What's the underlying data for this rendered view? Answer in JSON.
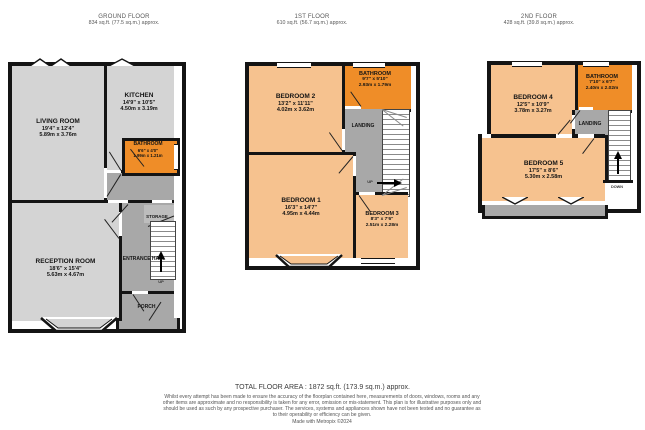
{
  "colors": {
    "wall": "#141414",
    "room_gray": "#d4d4d4",
    "hall_gray": "#a8a8a8",
    "bedroom_peach": "#f6c28f",
    "bathroom_orange": "#ef8d28"
  },
  "floors": [
    {
      "name": "GROUND FLOOR",
      "area": "834 sq.ft. (77.5 sq.m.) approx.",
      "rooms": {
        "living": {
          "name": "LIVING ROOM",
          "imperial": "19'4\" x 12'4\"",
          "metric": "5.89m x 3.76m"
        },
        "kitchen": {
          "name": "KITCHEN",
          "imperial": "14'9\" x 10'5\"",
          "metric": "4.50m x 3.19m"
        },
        "bathroom": {
          "name": "BATHROOM",
          "imperial": "6'6\" x 4'0\"",
          "metric": "1.99m x 1.21m"
        },
        "reception": {
          "name": "RECEPTION ROOM",
          "imperial": "18'6\" x 15'4\"",
          "metric": "5.63m x 4.67m"
        },
        "entrance": {
          "name": "ENTRANCE HALL"
        },
        "storage": {
          "name": "STORAGE"
        },
        "porch": {
          "name": "PORCH"
        }
      },
      "stairs": {
        "label": "UP"
      }
    },
    {
      "name": "1ST FLOOR",
      "area": "610 sq.ft. (56.7 sq.m.) approx.",
      "rooms": {
        "bedroom2": {
          "name": "BEDROOM 2",
          "imperial": "13'2\" x 11'11\"",
          "metric": "4.02m x 3.62m"
        },
        "bathroom": {
          "name": "BATHROOM",
          "imperial": "9'7\" x 5'10\"",
          "metric": "2.93m x 1.79m"
        },
        "landing": {
          "name": "LANDING"
        },
        "bedroom1": {
          "name": "BEDROOM 1",
          "imperial": "16'3\" x 14'7\"",
          "metric": "4.95m x 4.44m"
        },
        "bedroom3": {
          "name": "BEDROOM 3",
          "imperial": "8'3\" x 7'6\"",
          "metric": "2.51m x 2.28m"
        }
      },
      "stairs": {
        "label": "UP"
      }
    },
    {
      "name": "2ND FLOOR",
      "area": "428 sq.ft. (39.8 sq.m.) approx.",
      "rooms": {
        "bedroom4": {
          "name": "BEDROOM 4",
          "imperial": "12'5\" x 10'9\"",
          "metric": "3.78m x 3.27m"
        },
        "bathroom": {
          "name": "BATHROOM",
          "imperial": "7'10\" x 6'7\"",
          "metric": "2.40m x 2.02m"
        },
        "landing": {
          "name": "LANDING"
        },
        "bedroom5": {
          "name": "BEDROOM 5",
          "imperial": "17'5\" x 8'6\"",
          "metric": "5.30m x 2.58m"
        }
      },
      "stairs": {
        "label": "DOWN"
      }
    }
  ],
  "footer": {
    "total": "TOTAL FLOOR AREA : 1872 sq.ft. (173.9 sq.m.) approx.",
    "disclaimer": "Whilst every attempt has been made to ensure the accuracy of the floorplan contained here, measurements of doors, windows, rooms and any other items are approximate and no responsibility is taken for any error, omission or mis-statement. This plan is for illustrative purposes only and should be used as such by any prospective purchaser. The services, systems and appliances shown have not been tested and no guarantee as to their operability or efficiency can be given.",
    "credit": "Made with Metropix ©2024"
  }
}
